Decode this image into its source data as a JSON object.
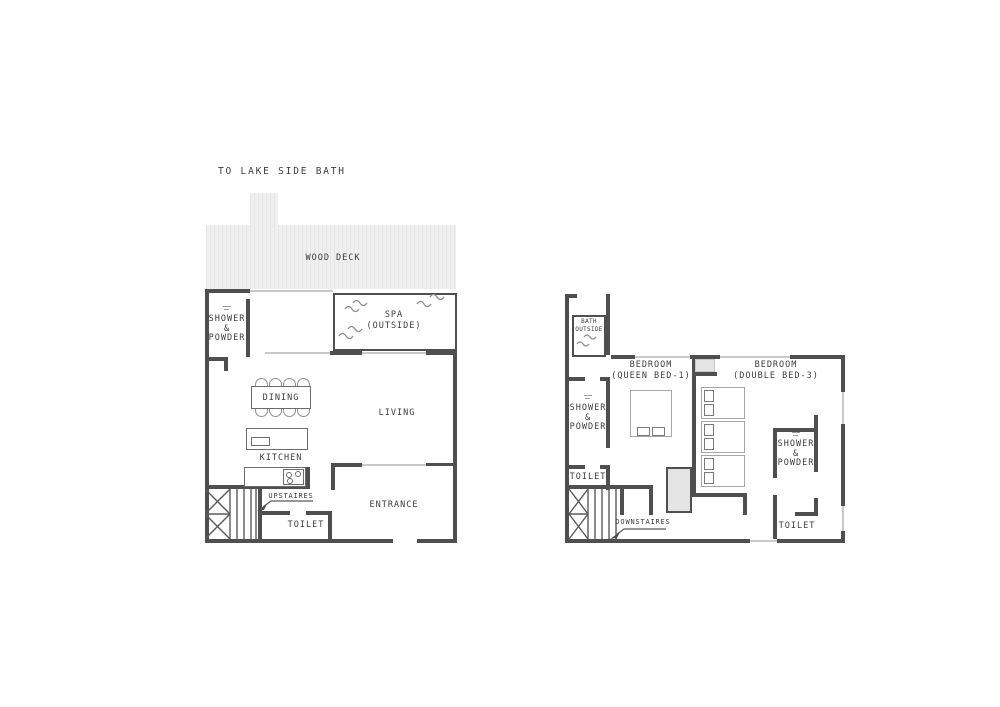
{
  "colors": {
    "wall": "#4f4f4f",
    "window": "#c9c9c9",
    "text": "#3d3d3d",
    "closet": "#e4e4e4",
    "deck_bg": "#f0f0f0",
    "deck_line": "#e5e5e5",
    "furn": "#6b6b6b",
    "furn_light": "#a6a6a6",
    "wave": "#8f8f8f",
    "stair": "#5a5a5a"
  },
  "site_label": "TO LAKE SIDE BATH",
  "ground_floor": {
    "wood_deck_label": "WOOD DECK",
    "spa_label": "SPA\n(OUTSIDE)",
    "shower_powder_label": "SHOWER\n&\nPOWDER",
    "dining_label": "DINING",
    "living_label": "LIVING",
    "kitchen_label": "KITCHEN",
    "upstairs_label": "UPSTAIRES",
    "toilet_label": "TOILET",
    "entrance_label": "ENTRANCE"
  },
  "upper_floor": {
    "bath_label": "BATH\n(OUTSIDE)",
    "bedroom_queen_label": "BEDROOM\n(QUEEN BED-1)",
    "bedroom_double_label": "BEDROOM\n(DOUBLE BED-3)",
    "shower_powder_left_label": "SHOWER\n&\nPOWDER",
    "shower_powder_right_label": "SHOWER\n&\nPOWDER",
    "toilet_left_label": "TOILET",
    "toilet_right_label": "TOILET",
    "downstairs_label": "DOWNSTAIRES"
  }
}
